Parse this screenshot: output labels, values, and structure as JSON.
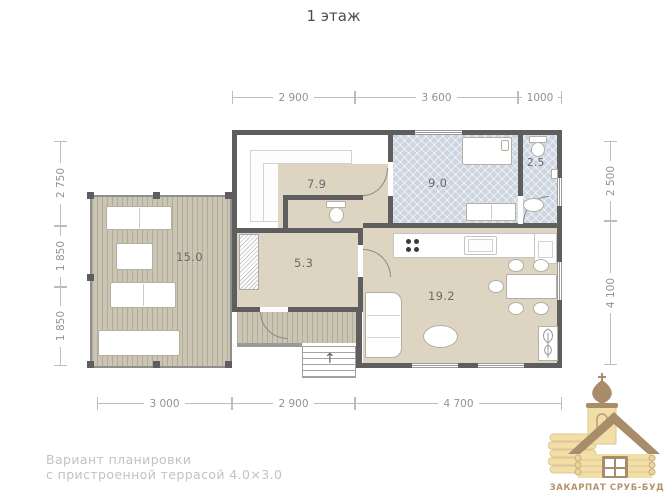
{
  "title": "1 этаж",
  "dims": {
    "top": [
      "2 900",
      "3 600",
      "1000"
    ],
    "left": [
      "2 750",
      "1 850",
      "1 850"
    ],
    "right": [
      "2 500",
      "4 100"
    ],
    "bottom": [
      "3 000",
      "2 900",
      "4 700"
    ]
  },
  "rooms": {
    "hall": "7.9",
    "bedroom": "9.0",
    "bath": "2.5",
    "terrace": "15.0",
    "corridor": "5.3",
    "living": "19.2"
  },
  "caption": {
    "line1": "Вариант планировки",
    "line2": "с пристроенной террасой 4.0×3.0"
  },
  "logo": {
    "name": "ЗАКАРПАТ СРУБ-БУД"
  },
  "colors": {
    "wall": "#5e5e5e",
    "floor_beige": "#ddd4c2",
    "floor_tile": "#ccd5e0",
    "deck": "#cbc5b3",
    "dim_line": "#bdbdbd",
    "logo_brown": "#a98c6a",
    "logo_tan": "#f2dfa8"
  }
}
